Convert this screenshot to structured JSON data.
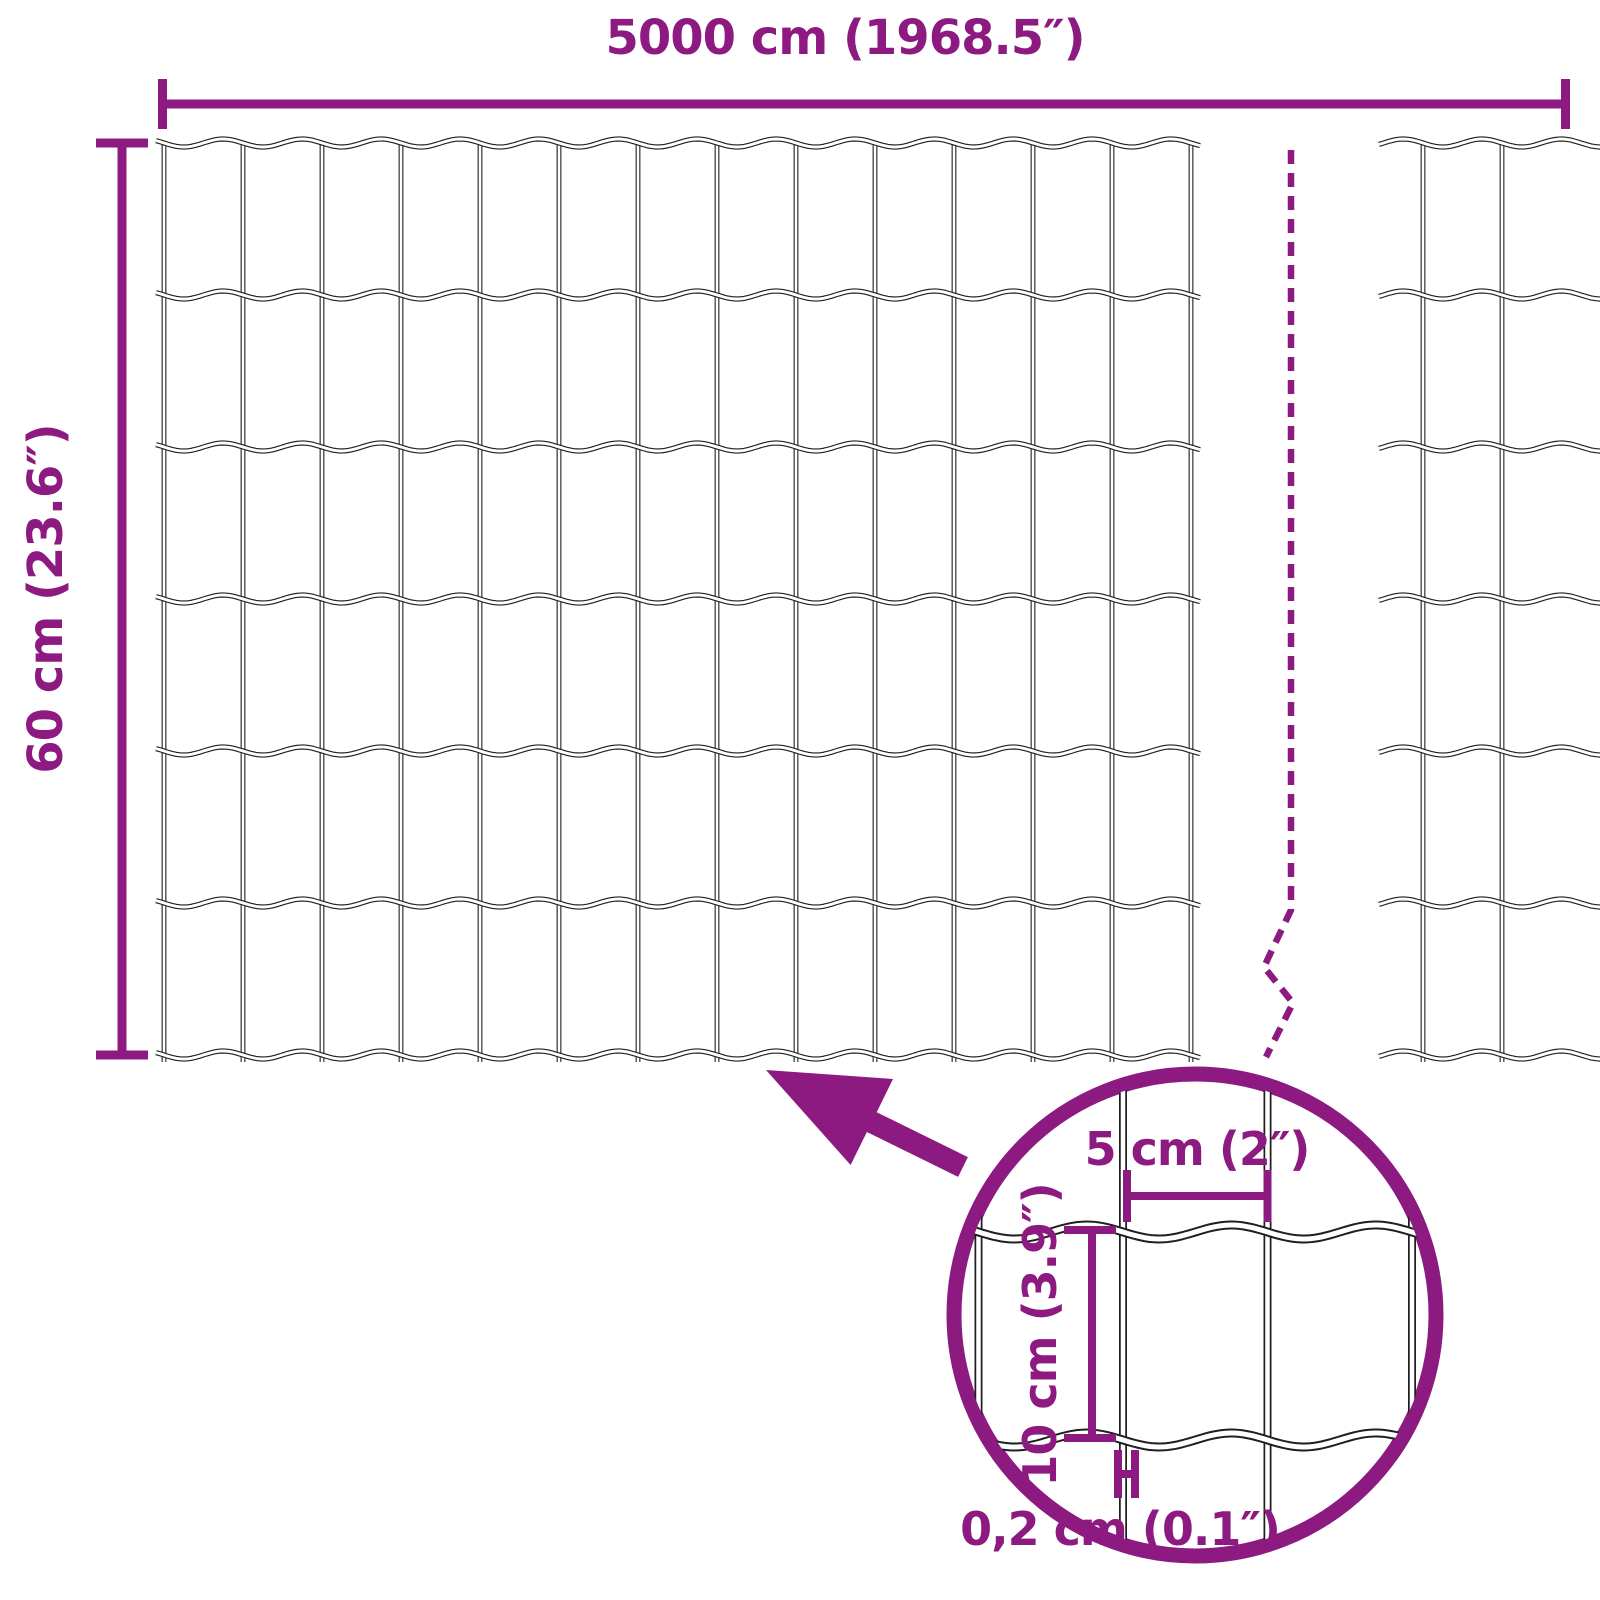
{
  "colors": {
    "accent": "#8C1A80",
    "wire": "#1f1f1f",
    "background": "#ffffff"
  },
  "dimensions": {
    "total_width": {
      "label": "5000 cm (1968.5″)",
      "cm": 5000,
      "inches": 1968.5
    },
    "total_height": {
      "label": "60 cm (23.6″)",
      "cm": 60,
      "inches": 23.6
    }
  },
  "detail_view": {
    "mesh_opening_width": {
      "label": "5 cm (2″)",
      "cm": 5,
      "inches": 2
    },
    "mesh_opening_height": {
      "label": "10 cm (3.9″)",
      "cm": 10,
      "inches": 3.9
    },
    "wire_thickness": {
      "label": "0,2 cm (0.1″)",
      "cm": 0.2,
      "inches": 0.1
    }
  },
  "mesh": {
    "main_panel_columns": 13,
    "main_panel_rows": 6,
    "continuation_panel_columns": 2
  }
}
